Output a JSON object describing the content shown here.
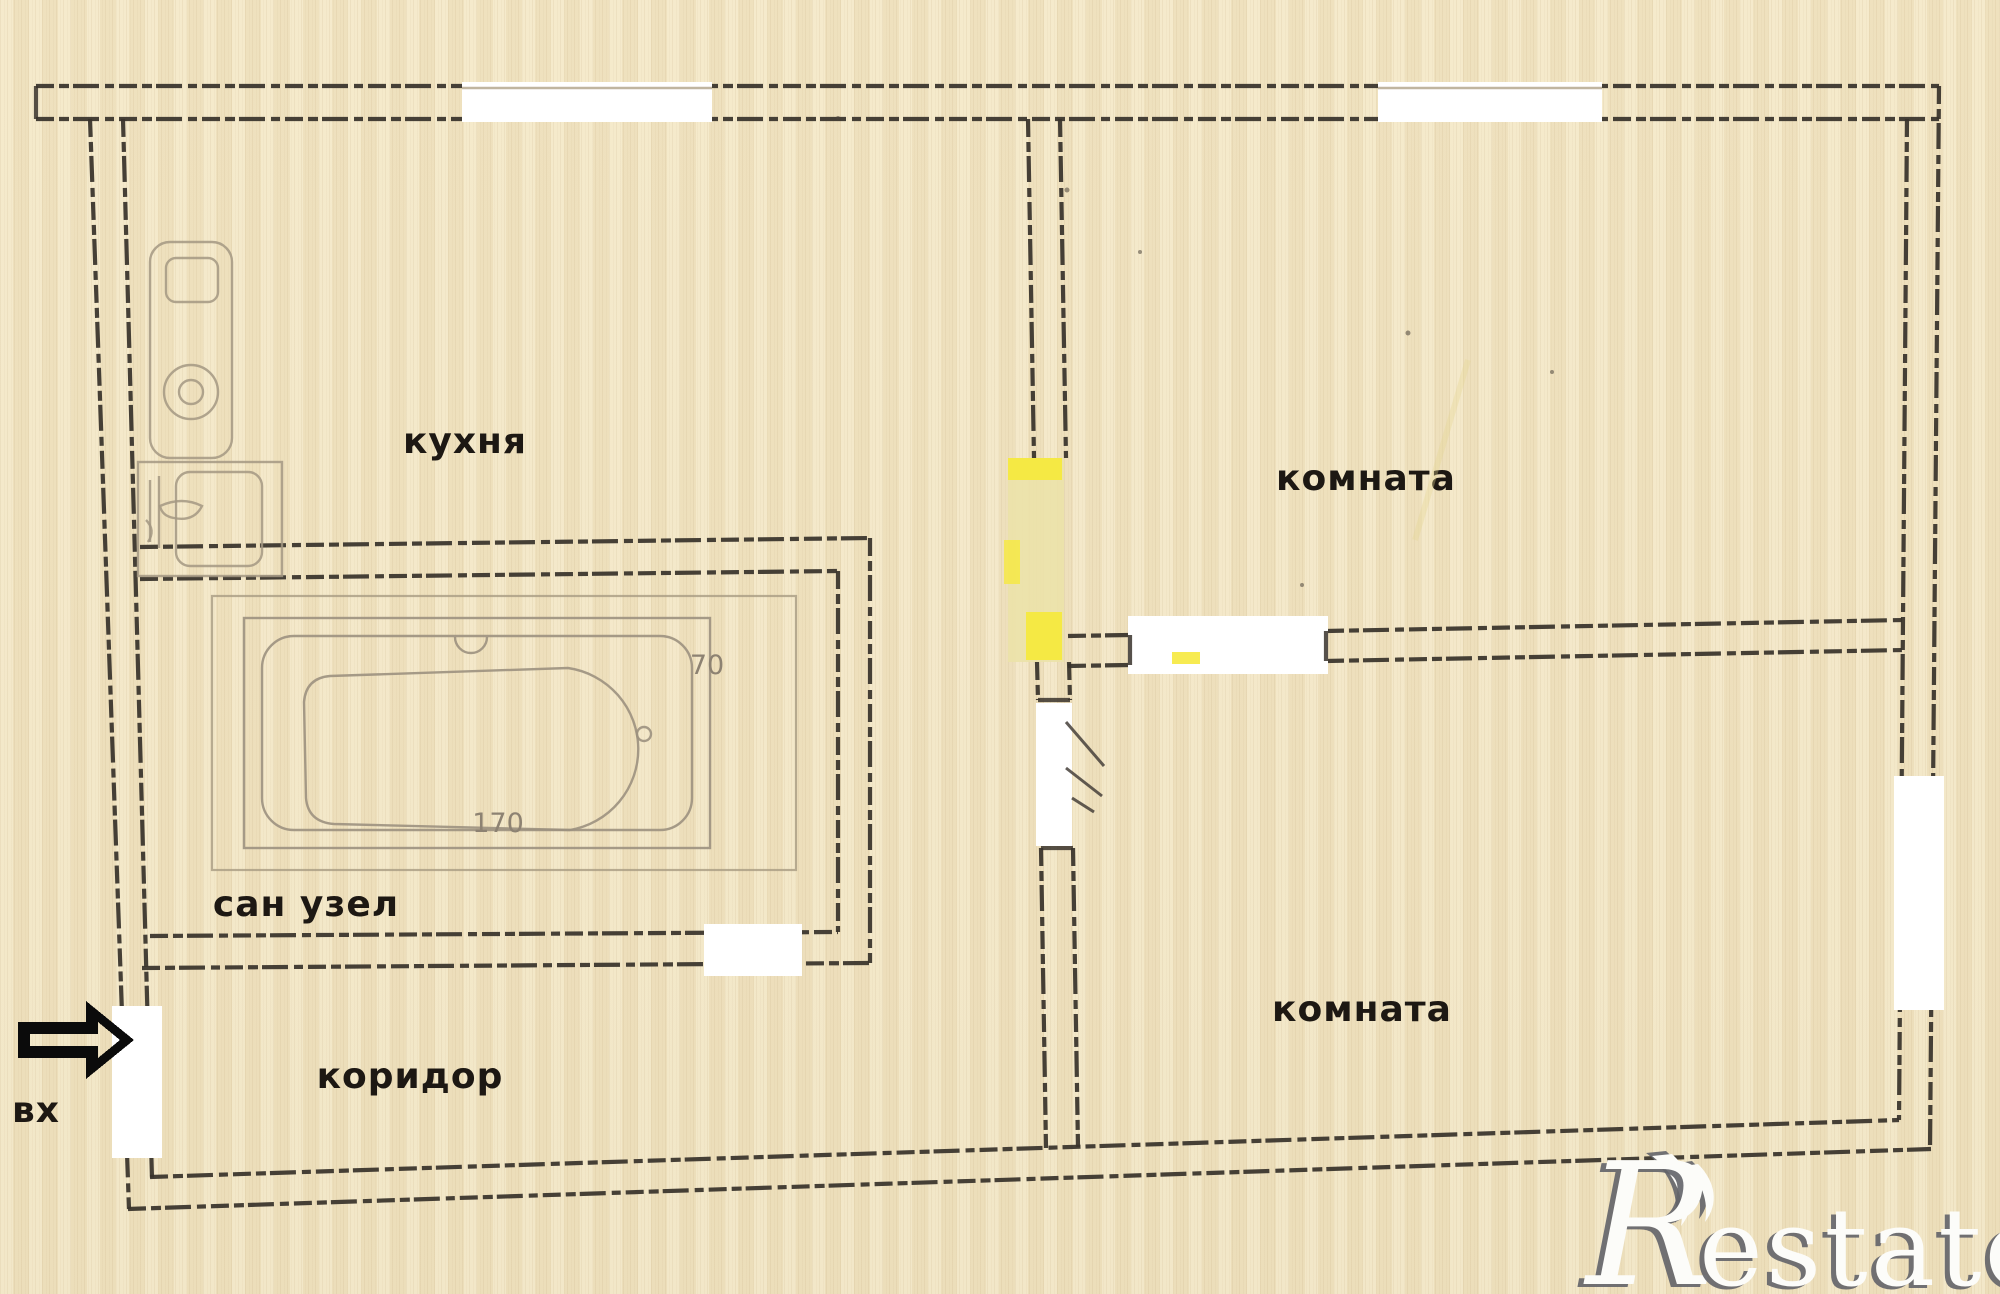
{
  "plan": {
    "rooms": {
      "kitchen": {
        "label": "кухня"
      },
      "room_top": {
        "label": "комната"
      },
      "room_bottom": {
        "label": "комната"
      },
      "bathroom": {
        "label": "сан узел"
      },
      "corridor": {
        "label": "коридор"
      }
    },
    "entrance": {
      "label": "вх"
    },
    "bathtub": {
      "length_cm": "170",
      "width_cm": "70"
    }
  },
  "watermark": {
    "initial": "R",
    "rest": "estate"
  },
  "colors": {
    "paper": "#f1e5c3",
    "wall_line": "#38332b",
    "thin_line": "#a79b82",
    "highlight_yellow": "#f6e93e",
    "highlight_pale_yellow": "#ebe2a8",
    "opening_white": "#ffffff",
    "label_text": "#1d1813",
    "dimension_text": "#8d8272",
    "watermark_gray": "#63646a",
    "watermark_white": "#fcfcf9"
  }
}
